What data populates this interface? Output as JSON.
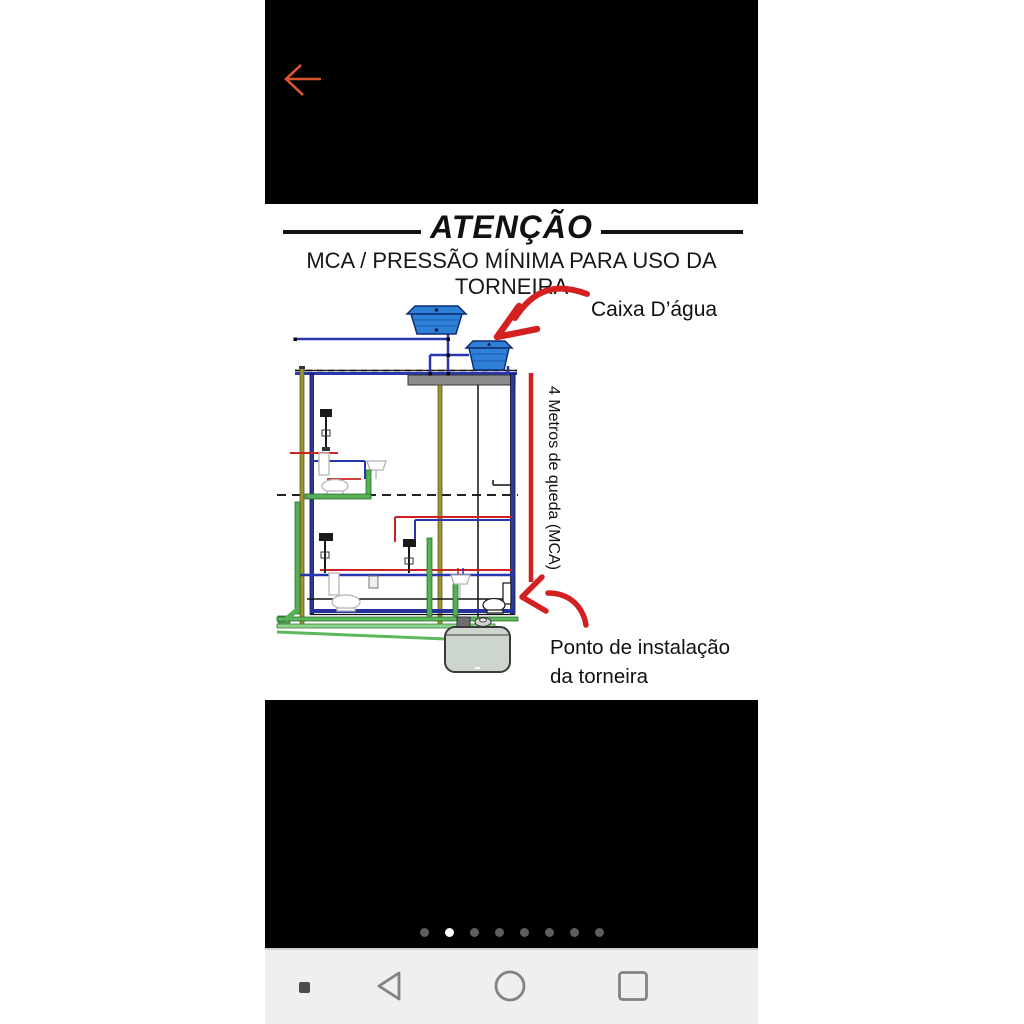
{
  "screen": {
    "top_bar": {
      "back_icon": "left-arrow",
      "back_icon_color": "#d9542f"
    },
    "warning": {
      "title": "ATENÇÃO",
      "subtitle": "MCA / PRESSÃO MÍNIMA PARA USO DA TORNEIRA"
    },
    "diagram": {
      "labels": {
        "water_tank": "Caixa D’água",
        "drop_height": "4 Metros de queda (MCA)",
        "install_point_line1": "Ponto de instalação",
        "install_point_line2": "da torneira"
      },
      "colors": {
        "cold_water_pipe": "#2a36b0",
        "hot_water_pipe": "#cc2222",
        "sewage_pipe": "#56ae56",
        "vent_pipe": "#9a9433",
        "annotation_red": "#d42020",
        "tank_blue": "#2e7fd8",
        "slab_gray": "#8c8c8c"
      }
    },
    "carousel": {
      "total_dots": 8,
      "active_index": 1
    },
    "nav_bar": {
      "icons": [
        "pin-square",
        "back-triangle",
        "home-circle",
        "recents-square"
      ]
    }
  }
}
